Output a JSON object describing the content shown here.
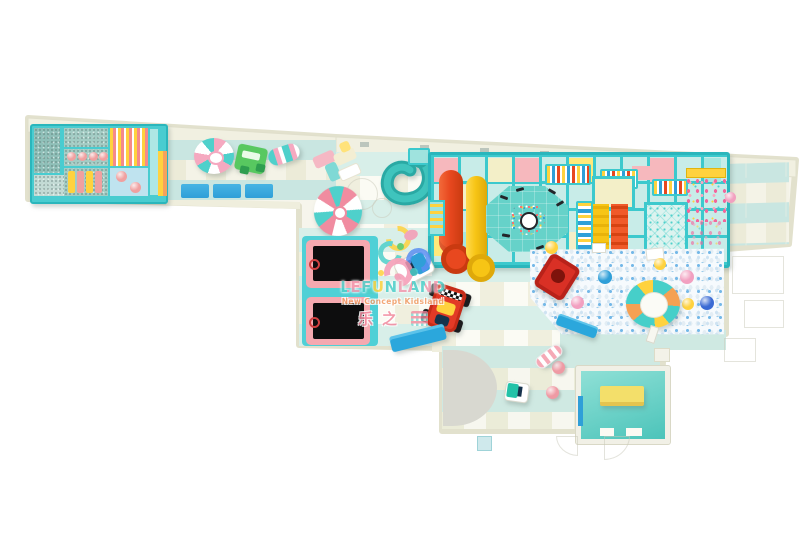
{
  "watermark": {
    "brand": "LEFUNLAND",
    "tagline": "New Concept Kidsland",
    "chinese_name": "乐之"
  },
  "palette": {
    "frame_teal": "#3ac9cd",
    "soft_pink": "#f5a9b6",
    "pastel_yellow": "#ffe27a",
    "slide_red": "#e8481f",
    "slide_yellow": "#f7c515",
    "spiral_slide_teal": "#2aa9a4",
    "ball_pit_white": "#f6fafd",
    "ball_blue": "#2f9fd8",
    "ball_pink": "#f2a0c0",
    "ball_yellow": "#ffd23e",
    "floor_teal": "#c9e6e1",
    "floor_cream": "#ecebd8",
    "trampoline_black": "#0d0d0e",
    "trampoline_frame_pink": "#f5a9b0",
    "room_teal": "#5fd3c8",
    "bench_yellow": "#f3df6a",
    "wall_cream": "#f1f0e1",
    "kart_red": "#e23a26",
    "confetti_pink": "#f2679c"
  }
}
